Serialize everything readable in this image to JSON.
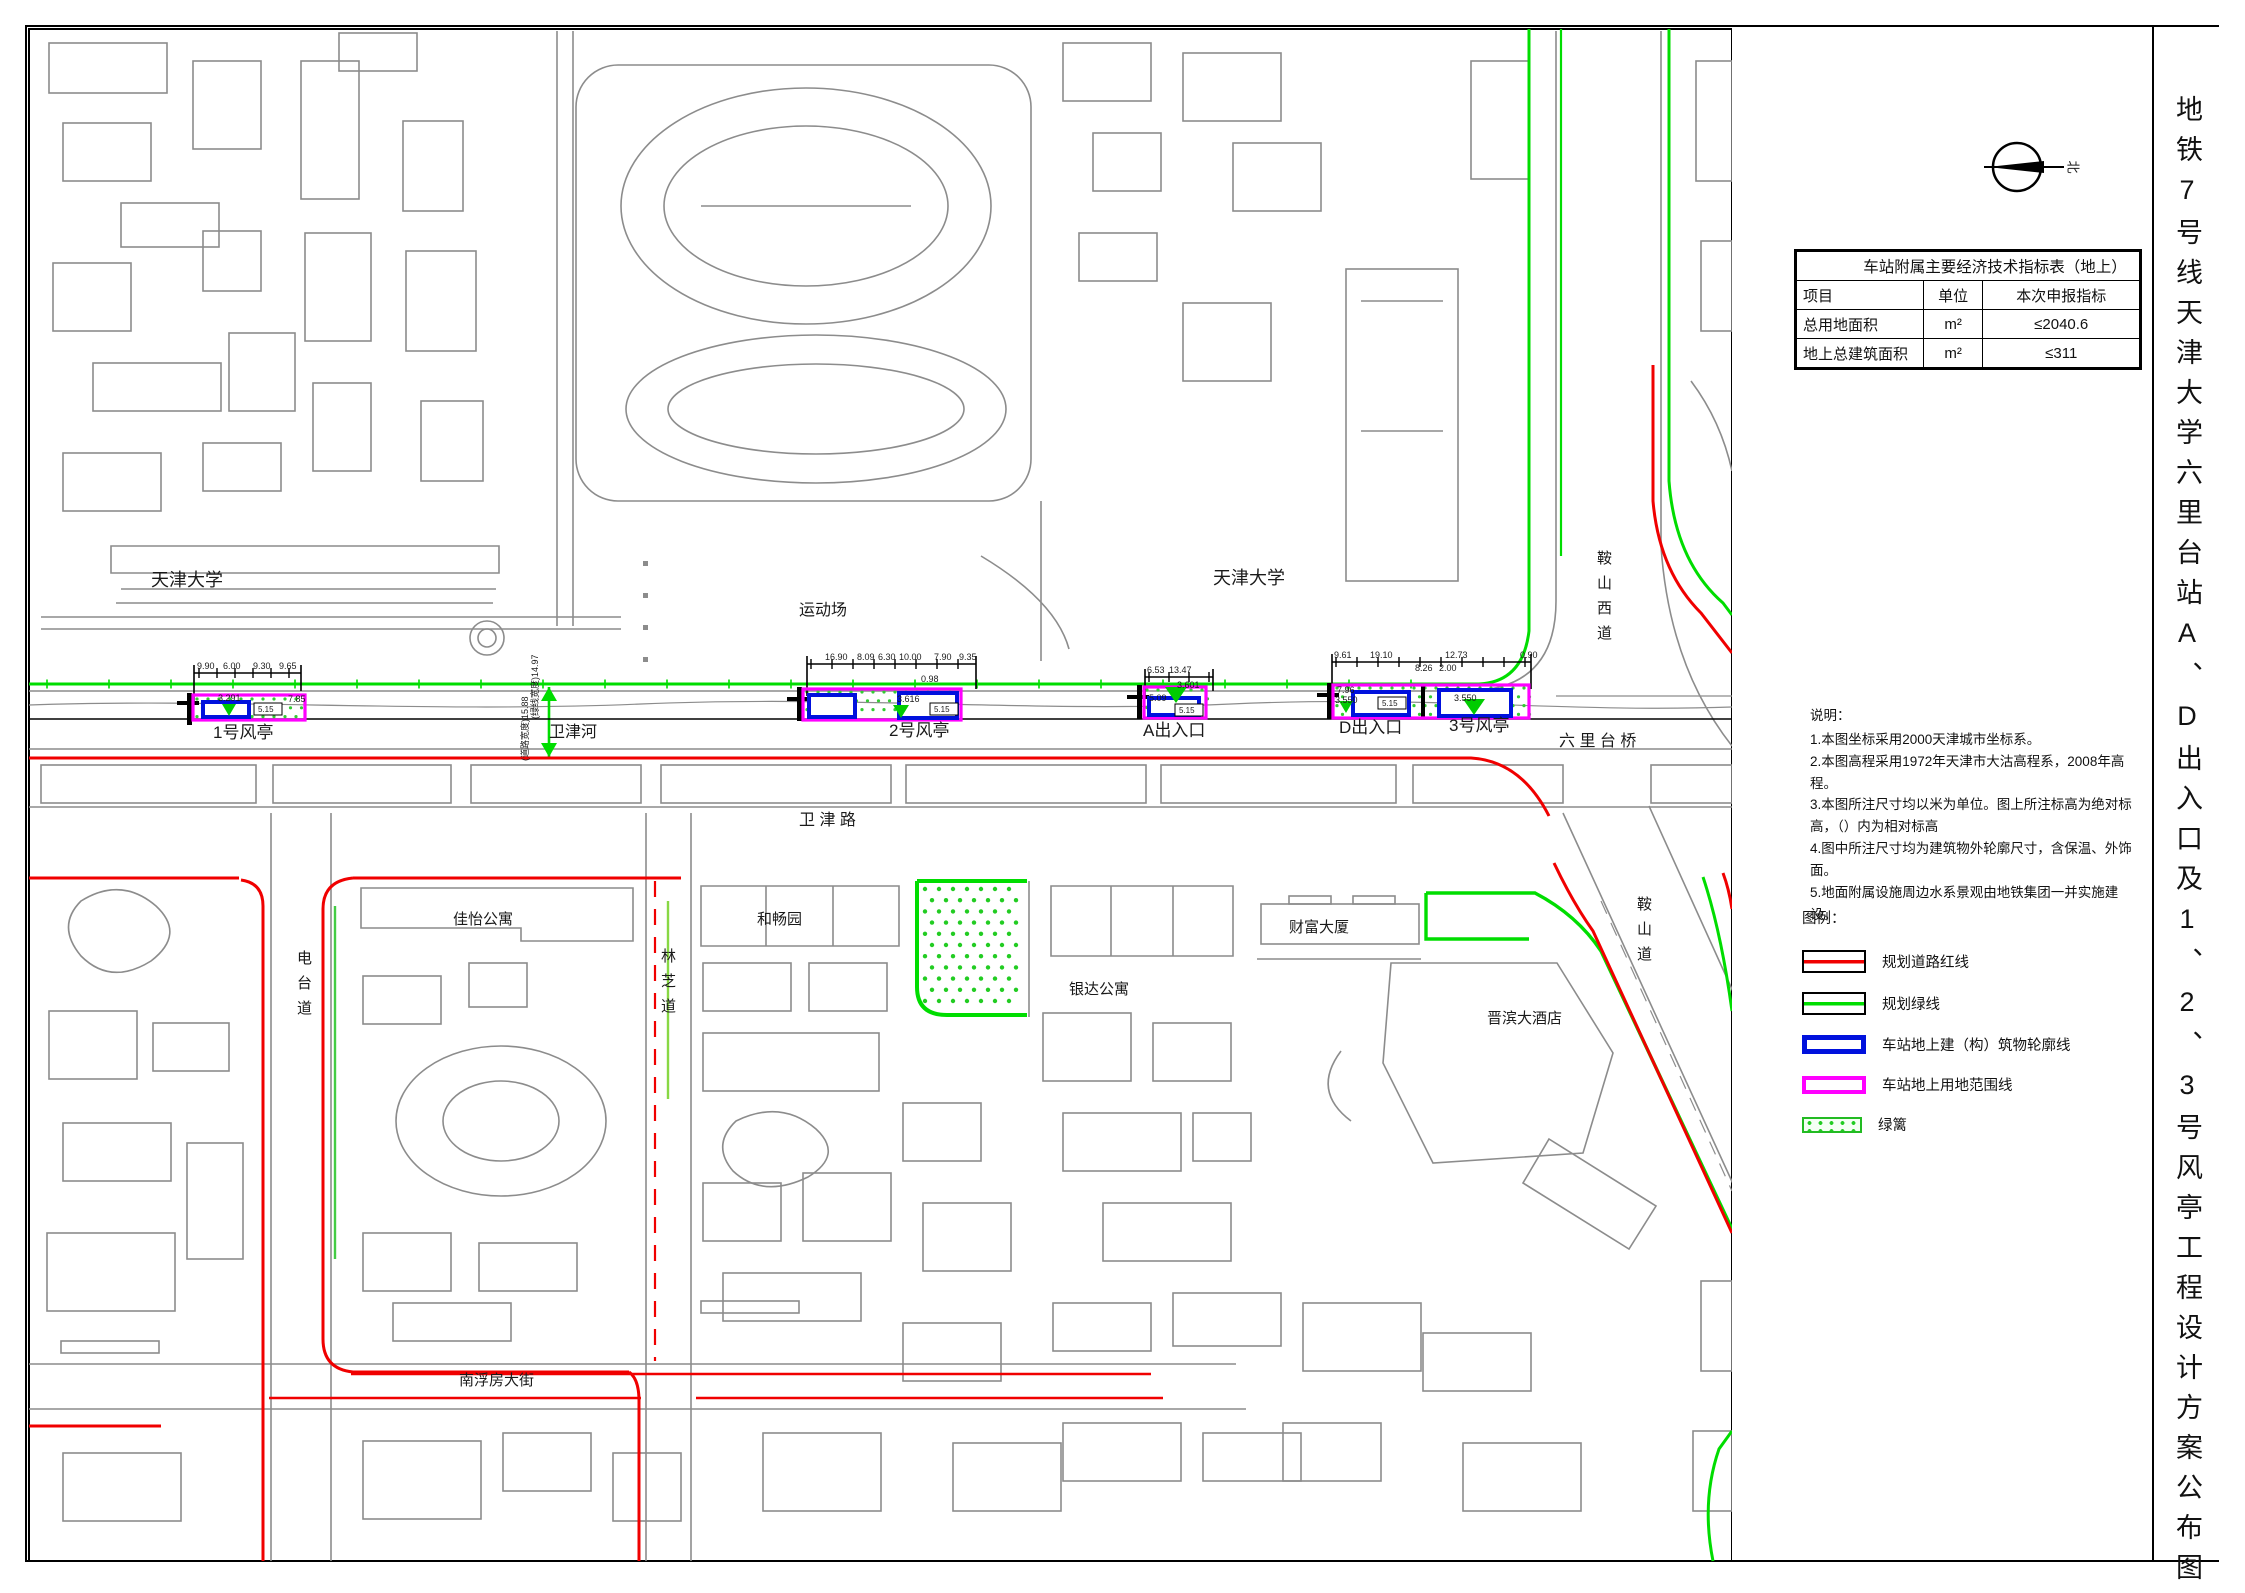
{
  "title_strip": {
    "text": "地铁7号线天津大学六里台站A、D出入口及1、2、3号风亭工程设计方案公布图"
  },
  "north_arrow": {
    "label": "北"
  },
  "table": {
    "title": "车站附属主要经济技术指标表（地上）",
    "headers": [
      "项目",
      "单位",
      "本次申报指标"
    ],
    "rows": [
      {
        "item": "总用地面积",
        "unit": "m²",
        "value": "≤2040.6"
      },
      {
        "item": "地上总建筑面积",
        "unit": "m²",
        "value": "≤311"
      }
    ]
  },
  "notes": {
    "heading": "说明：",
    "items": [
      "1.本图坐标采用2000天津城市坐标系。",
      "2.本图高程采用1972年天津市大沽高程系，2008年高程。",
      "3.本图所注尺寸均以米为单位。图上所注标高为绝对标高，（）内为相对标高",
      "4.图中所注尺寸均为建筑物外轮廓尺寸，含保温、外饰面。",
      "5.地面附属设施周边水系景观由地铁集团一并实施建设。"
    ]
  },
  "legend": {
    "heading": "图例：",
    "items": [
      {
        "label": "规划道路红线",
        "type": "red-line"
      },
      {
        "label": "规划绿线",
        "type": "green-line"
      },
      {
        "label": "车站地上建（构）筑物轮廓线",
        "type": "blue-outline"
      },
      {
        "label": "车站地上用地范围线",
        "type": "magenta-outline"
      },
      {
        "label": "绿篱",
        "type": "hedge"
      }
    ]
  },
  "colors": {
    "road_red_line": "#f00000",
    "green_line": "#00dd00",
    "station_outline_blue": "#0011dd",
    "land_boundary_magenta": "#ff00ff",
    "base_map_gray": "#8c8c8c"
  },
  "map": {
    "labels": [
      {
        "text": "天津大学",
        "x": 150,
        "y": 585,
        "size": 18,
        "name": "place-label-tianjin-university-west"
      },
      {
        "text": "天津大学",
        "x": 1212,
        "y": 583,
        "size": 18,
        "name": "place-label-tianjin-university-east"
      },
      {
        "text": "运动场",
        "x": 798,
        "y": 614,
        "size": 16,
        "name": "place-label-sports-field"
      },
      {
        "text": "卫津河",
        "x": 548,
        "y": 736,
        "size": 16,
        "name": "place-label-weijin-river"
      },
      {
        "text": "卫 津 路",
        "x": 798,
        "y": 824,
        "size": 16,
        "name": "road-label-weijin-road"
      },
      {
        "text": "六 里 台 桥",
        "x": 1558,
        "y": 745,
        "size": 16,
        "name": "road-label-liulitai-bridge"
      },
      {
        "text": "1号风亭",
        "x": 212,
        "y": 737,
        "size": 17,
        "name": "station-structure-label-vent-1"
      },
      {
        "text": "2号风亭",
        "x": 888,
        "y": 735,
        "size": 17,
        "name": "station-structure-label-vent-2"
      },
      {
        "text": "A出入口",
        "x": 1142,
        "y": 735,
        "size": 17,
        "name": "station-structure-label-entrance-a"
      },
      {
        "text": "D出入口",
        "x": 1338,
        "y": 732,
        "size": 17,
        "name": "station-structure-label-entrance-d"
      },
      {
        "text": "3号风亭",
        "x": 1448,
        "y": 730,
        "size": 17,
        "name": "station-structure-label-vent-3"
      },
      {
        "text": "佳怡公寓",
        "x": 452,
        "y": 923,
        "size": 15,
        "name": "place-label-jiayi-apartment"
      },
      {
        "text": "和畅园",
        "x": 756,
        "y": 923,
        "size": 15,
        "name": "place-label-hechang-garden"
      },
      {
        "text": "银达公寓",
        "x": 1068,
        "y": 993,
        "size": 15,
        "name": "place-label-yinda-apartment"
      },
      {
        "text": "财富大厦",
        "x": 1288,
        "y": 931,
        "size": 15,
        "name": "place-label-fortune-tower"
      },
      {
        "text": "晋滨大酒店",
        "x": 1486,
        "y": 1022,
        "size": 15,
        "name": "place-label-jinbin-hotel"
      },
      {
        "text": "南浮房大街",
        "x": 458,
        "y": 1384,
        "size": 15,
        "name": "road-label-nanfufang-street"
      },
      {
        "text": "电台道",
        "x": 296,
        "y": 962,
        "size": 15,
        "vertical": true,
        "name": "road-label-diantai-road"
      },
      {
        "text": "林芝道",
        "x": 660,
        "y": 960,
        "size": 15,
        "vertical": true,
        "name": "road-label-linzhi-road"
      },
      {
        "text": "鞍山道",
        "x": 1636,
        "y": 908,
        "size": 15,
        "vertical": true,
        "name": "road-label-anshan-road"
      },
      {
        "text": "鞍山西道",
        "x": 1596,
        "y": 562,
        "size": 15,
        "vertical": true,
        "name": "road-label-anshan-west-road"
      },
      {
        "text": "9.90",
        "x": 196,
        "y": 668,
        "size": 9,
        "name": "dimension-label"
      },
      {
        "text": "6.00",
        "x": 222,
        "y": 668,
        "size": 9,
        "name": "dimension-label"
      },
      {
        "text": "9.30",
        "x": 252,
        "y": 668,
        "size": 9,
        "name": "dimension-label"
      },
      {
        "text": "9.65",
        "x": 278,
        "y": 668,
        "size": 9,
        "name": "dimension-label"
      },
      {
        "text": "3.291",
        "x": 217,
        "y": 700,
        "size": 9,
        "name": "dimension-label"
      },
      {
        "text": "7.85",
        "x": 287,
        "y": 701,
        "size": 9,
        "name": "dimension-label"
      },
      {
        "text": "5.15",
        "x": 257,
        "y": 711,
        "size": 8,
        "name": "dimension-label"
      },
      {
        "text": "16.90",
        "x": 824,
        "y": 659,
        "size": 9,
        "name": "dimension-label"
      },
      {
        "text": "8.09",
        "x": 856,
        "y": 659,
        "size": 9,
        "name": "dimension-label"
      },
      {
        "text": "6.30",
        "x": 877,
        "y": 659,
        "size": 9,
        "name": "dimension-label"
      },
      {
        "text": "10.00",
        "x": 898,
        "y": 659,
        "size": 9,
        "name": "dimension-label"
      },
      {
        "text": "7.90",
        "x": 933,
        "y": 659,
        "size": 9,
        "name": "dimension-label"
      },
      {
        "text": "9.35",
        "x": 958,
        "y": 659,
        "size": 9,
        "name": "dimension-label"
      },
      {
        "text": "0.98",
        "x": 920,
        "y": 681,
        "size": 9,
        "name": "dimension-label"
      },
      {
        "text": "3.616",
        "x": 896,
        "y": 701,
        "size": 9,
        "name": "dimension-label"
      },
      {
        "text": "5.15",
        "x": 933,
        "y": 711,
        "size": 8,
        "name": "dimension-label"
      },
      {
        "text": "6.53",
        "x": 1146,
        "y": 672,
        "size": 9,
        "name": "dimension-label"
      },
      {
        "text": "13.47",
        "x": 1168,
        "y": 672,
        "size": 9,
        "name": "dimension-label"
      },
      {
        "text": "3.601",
        "x": 1176,
        "y": 687,
        "size": 9,
        "name": "dimension-label"
      },
      {
        "text": "5.09",
        "x": 1148,
        "y": 700,
        "size": 9,
        "name": "dimension-label"
      },
      {
        "text": "5.15",
        "x": 1178,
        "y": 712,
        "size": 8,
        "name": "dimension-label"
      },
      {
        "text": "9.61",
        "x": 1333,
        "y": 657,
        "size": 9,
        "name": "dimension-label"
      },
      {
        "text": "19.10",
        "x": 1369,
        "y": 657,
        "size": 9,
        "name": "dimension-label"
      },
      {
        "text": "12.73",
        "x": 1444,
        "y": 657,
        "size": 9,
        "name": "dimension-label"
      },
      {
        "text": "0.90",
        "x": 1519,
        "y": 657,
        "size": 9,
        "name": "dimension-label"
      },
      {
        "text": "8.26",
        "x": 1414,
        "y": 670,
        "size": 9,
        "name": "dimension-label"
      },
      {
        "text": "2.00",
        "x": 1438,
        "y": 670,
        "size": 9,
        "name": "dimension-label"
      },
      {
        "text": "7.96",
        "x": 1336,
        "y": 692,
        "size": 9,
        "name": "dimension-label"
      },
      {
        "text": "3.550",
        "x": 1334,
        "y": 702,
        "size": 9,
        "name": "dimension-label"
      },
      {
        "text": "5.15",
        "x": 1381,
        "y": 705,
        "size": 8,
        "name": "dimension-label"
      },
      {
        "text": "3.550",
        "x": 1453,
        "y": 700,
        "size": 9,
        "name": "dimension-label"
      },
      {
        "text": "(绿线宽度)14.97",
        "x": 537,
        "y": 718,
        "size": 9,
        "rotate": -90,
        "name": "dimension-label"
      },
      {
        "text": "(道路宽度)15.88",
        "x": 527,
        "y": 760,
        "size": 9,
        "rotate": -90,
        "name": "dimension-label"
      }
    ]
  }
}
